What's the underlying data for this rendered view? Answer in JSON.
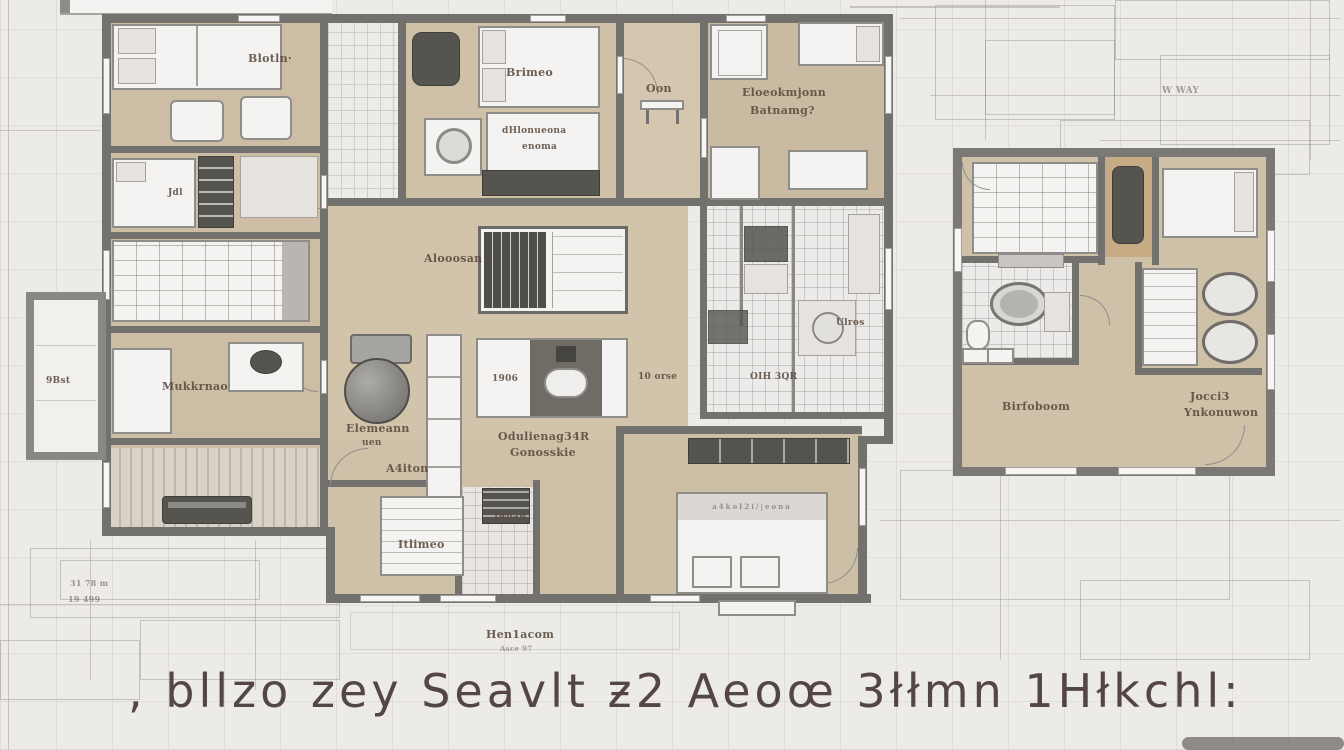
{
  "title": ", bllzo zey Seavlt ƶ2 Aeoœ 3łłmn 1Hłkchl:",
  "colors": {
    "background": "#edebe8",
    "floor_tan": "#cfc0a8",
    "wall_gray": "#73716d",
    "furniture_dark": "#56544f",
    "label_text": "#5b4a3e",
    "title_text": "#483a36"
  },
  "labels": {
    "bedroom_tl": "Blotln·",
    "jdl": "Jdl",
    "brimeo": "Brimeo",
    "oon": "Oon",
    "tr1": "Eloeokmjonn",
    "tr2": "Batnamg?",
    "desk1": "dHlonueona",
    "desk2": "enoma",
    "living": "Alooosan",
    "cab_num": "1906",
    "orse": "10 orse",
    "hall1": "Odulienag34R",
    "hall2": "Gonosskie",
    "mukk": "Mukkrnao",
    "elem1": "Elemeann",
    "elem2": "uen",
    "a4ton": "A4iton",
    "itlimeo": "Itlimeo",
    "iwoaw": "Iwoaw",
    "ulros": "Ulros",
    "oih": "OIH 3QR",
    "hen1": "Hen1acom",
    "hen2": "Asce 97",
    "closet": "9Bst",
    "bed_text": "a4koI2i/|eona",
    "rp_bedroom": "Birfoboom",
    "rp_kids1": "Jocci3",
    "rp_kids2": "Ynkonuwon",
    "sk1": "31 78 m",
    "sk2": "19 499",
    "sk3": "W WAY"
  }
}
